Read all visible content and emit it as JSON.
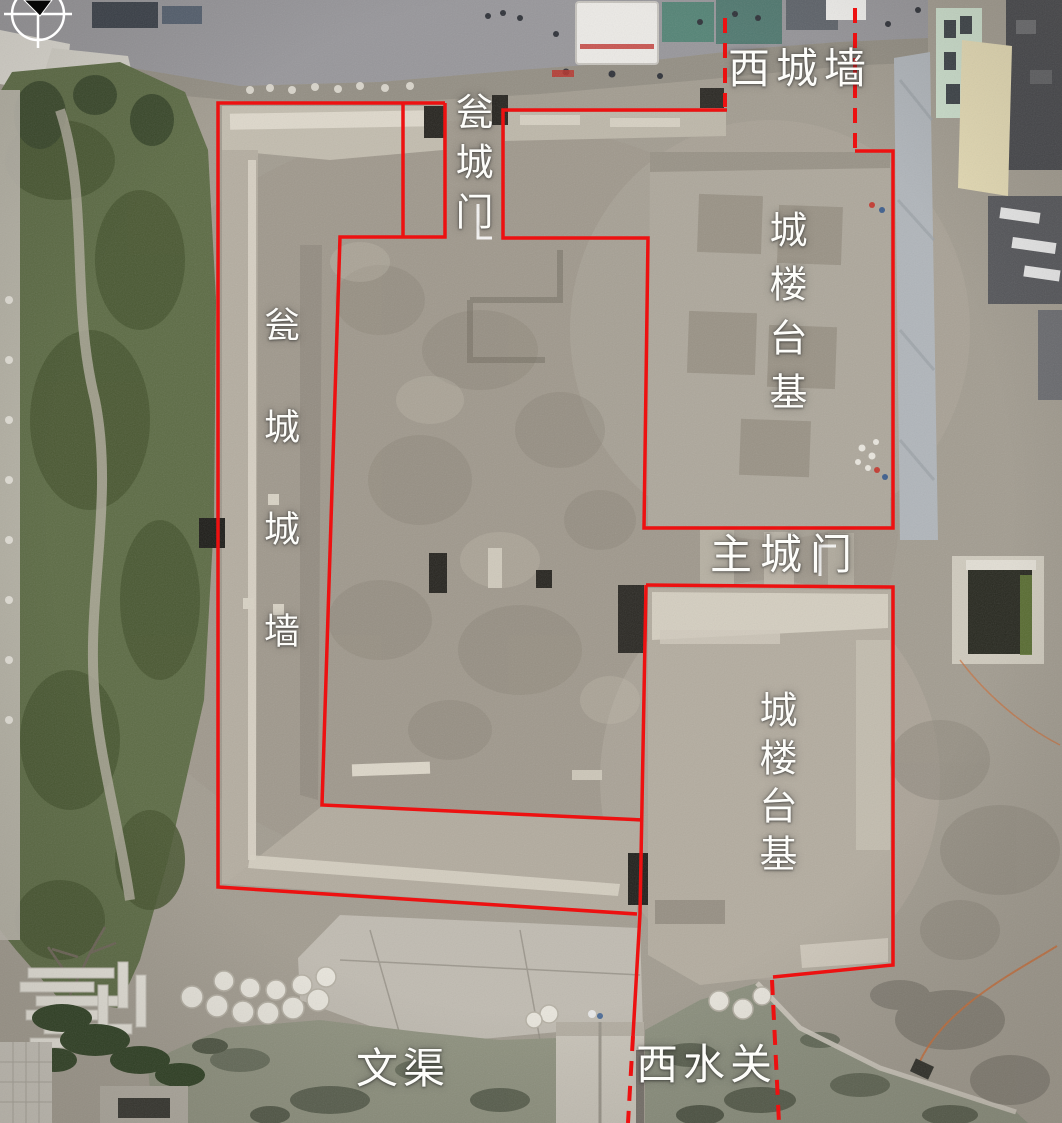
{
  "figure": {
    "kind": "annotated aerial photograph of an archaeological excavation"
  },
  "colors": {
    "annotation_red": "#ed1111",
    "label_text": "#ffffff"
  },
  "icons": {
    "north_arrow": "compass-circle-with-black-pointer"
  },
  "labels": {
    "west_city_wall": "西城墙",
    "barbican_gate": "瓮城门",
    "gate_tower_platform_upper": "城楼台基",
    "barbican_city_wall": "瓮城城墙",
    "main_city_gate": "主城门",
    "gate_tower_platform_lower": "城楼台基",
    "wen_canal": "文渠",
    "west_water_gate": "西水关"
  }
}
